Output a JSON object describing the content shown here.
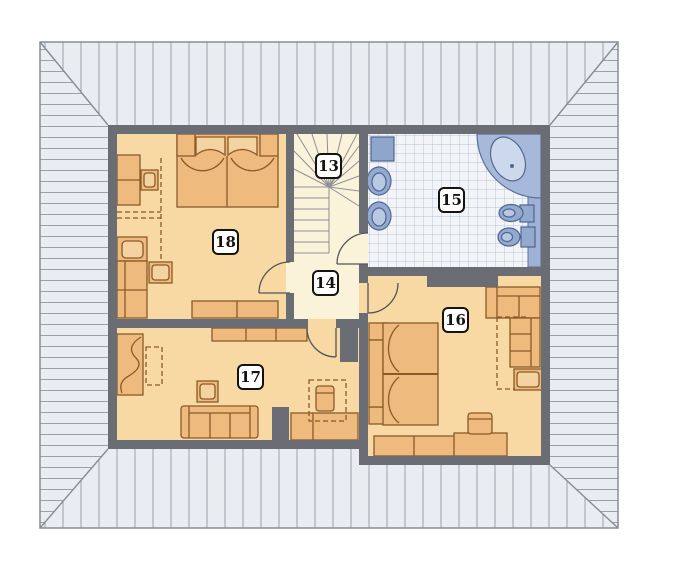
{
  "plan": {
    "labels": {
      "r13": "13",
      "r14": "14",
      "r15": "15",
      "r16": "16",
      "r17": "17",
      "r18": "18"
    },
    "colors": {
      "roof_fill": "#e9ecf1",
      "roof_hatch_line": "#9aa1ab",
      "wall": "#6a6e74",
      "room_floor": "#f8d9a3",
      "hall_floor": "#fbf2da",
      "furniture_fill": "#eeba7d",
      "furniture_outline": "#8a5a28",
      "bathroom_tile": "#f2f4f8",
      "bathroom_tile_line": "#b7c3d4",
      "fixture_blue": "#93a9ce",
      "fixture_outline": "#4e6493",
      "counter_strip": "#9fb2d5",
      "label_border": "#15130f"
    }
  }
}
